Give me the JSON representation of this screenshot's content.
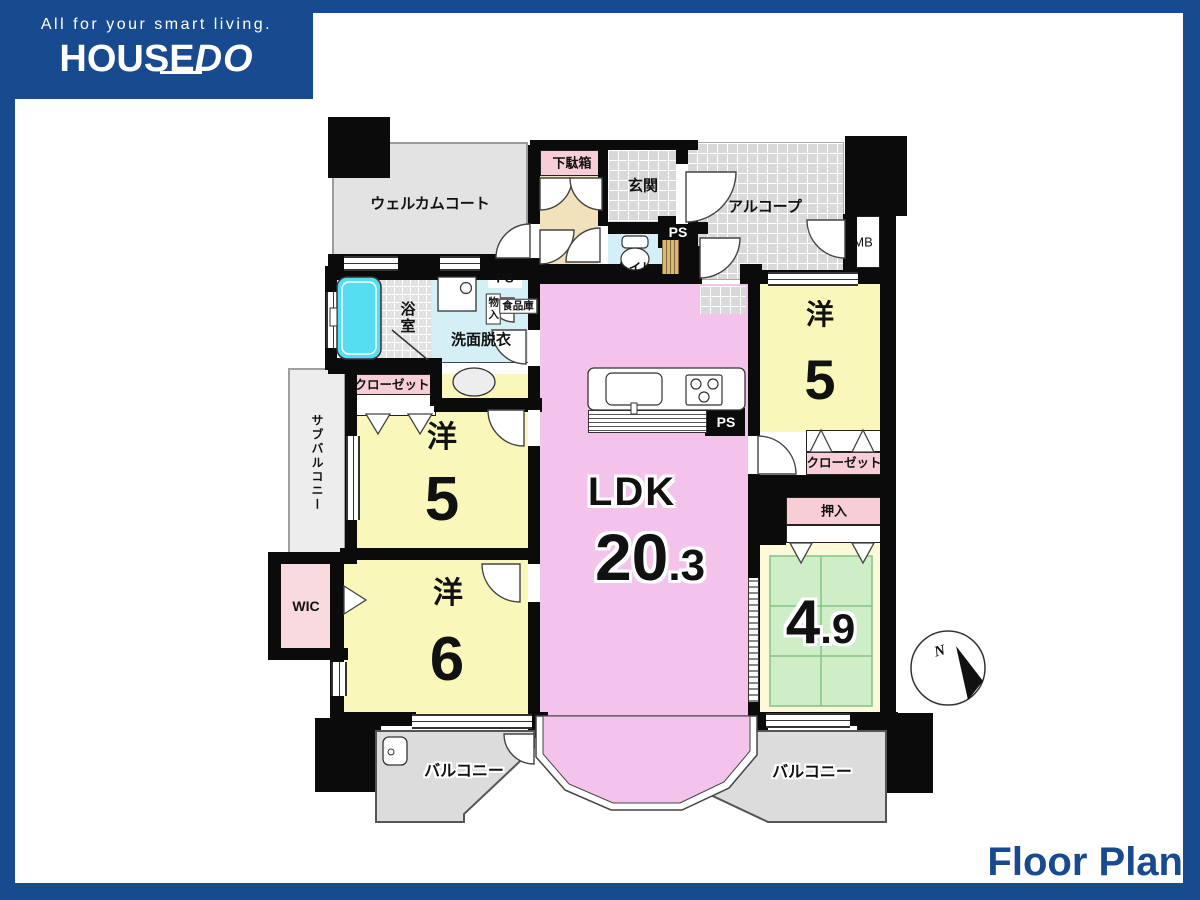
{
  "colors": {
    "brand_blue": "#174a8e",
    "wall": "#0b0b0b",
    "ldk_pink": "#f3c3eb",
    "room_yellow": "#faf7bb",
    "tatami_green": "#cdeec6",
    "tatami_line": "#85c285",
    "label_pink": "#f7ced6",
    "wic_pink": "#f9dade",
    "water_cyan": "#d4eff6",
    "tub_cyan": "#55ddf2",
    "tile_gray": "#d9d9d9",
    "court_gray": "#e3e3e3",
    "hall_beige": "#f1e2bc",
    "cream": "#fdf9d9",
    "wood": "#d8b878"
  },
  "brand": {
    "tagline": "All for your smart living.",
    "logo_main": "HOUSE",
    "logo_accent": "DO",
    "footer": "Floor Plan"
  },
  "labels": {
    "welcome_court": "ウェルカムコート",
    "shoe_box": "下駄箱",
    "entrance": "玄関",
    "alcove": "アルコープ",
    "mb": "MB",
    "ps": "PS",
    "toilet": "トイレ",
    "bath": "浴室",
    "washroom": "洗面脱衣",
    "storage": "物入",
    "pantry": "食品庫",
    "closet": "クローゼット",
    "sub_balcony": "サブバルコニー",
    "wic": "WIC",
    "oshiire": "押入",
    "balcony": "バルコニー",
    "north": "N"
  },
  "rooms": {
    "west5_left": {
      "type": "洋",
      "size": "5"
    },
    "west6": {
      "type": "洋",
      "size": "6"
    },
    "west5_right": {
      "type": "洋",
      "size": "5"
    },
    "ldk": {
      "name": "LDK",
      "size_int": "20",
      "size_dec": ".3"
    },
    "japanese": {
      "size_int": "4",
      "size_dec": ".9"
    }
  }
}
